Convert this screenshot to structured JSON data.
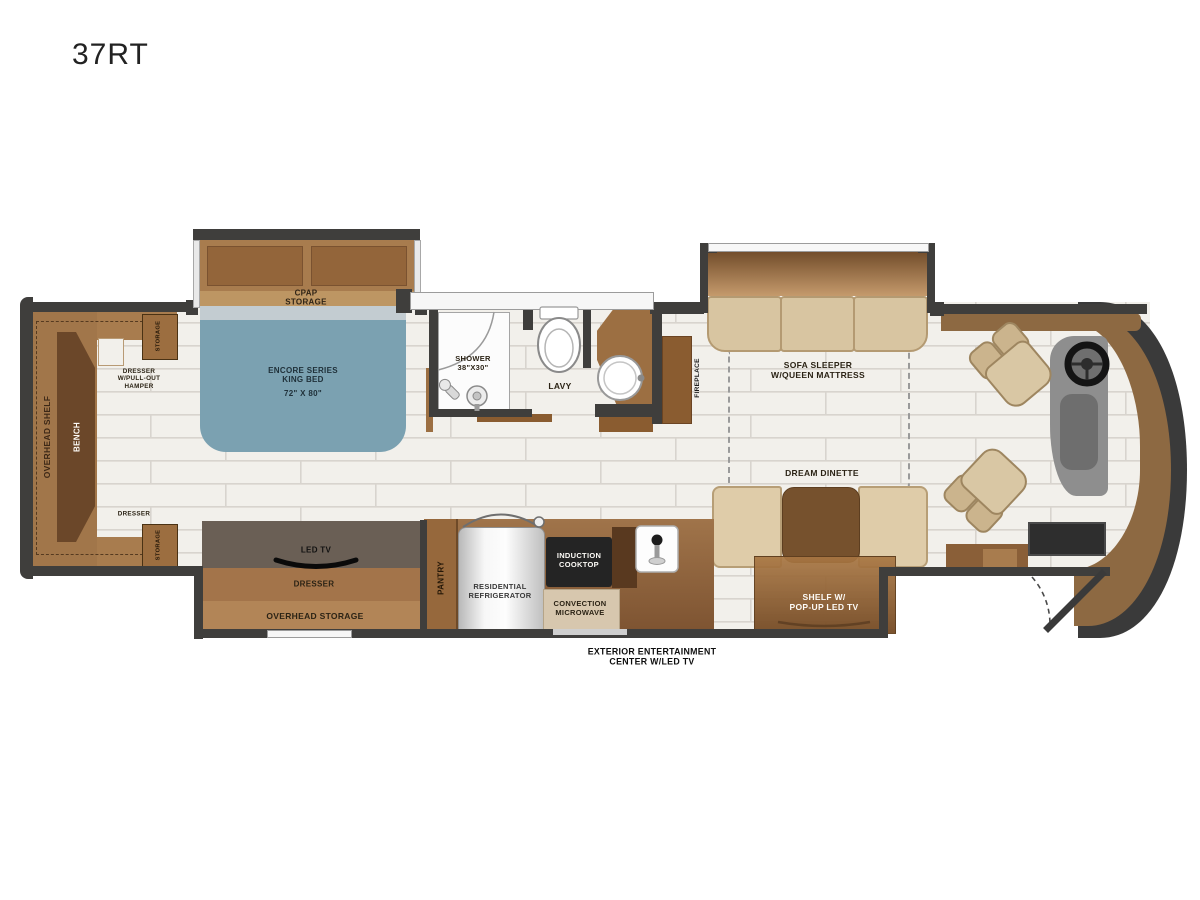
{
  "title": "37RT",
  "palette": {
    "wall": "#3f3e3c",
    "floor": "#f2f0eb",
    "cabinet_brown": "#9c6f42",
    "dark_brown": "#6d4a2b",
    "bed_blue": "#7ba1b1",
    "seat_tan": "#d9c7a4",
    "cooktop_black": "#222222",
    "fridge_silver": "#d9d9d9",
    "tv_taupe": "#6a5f55"
  },
  "bedroom": {
    "overhead_shelf": "OVERHEAD SHELF",
    "bench": "BENCH",
    "storage": "STORAGE",
    "hamper_l1": "DRESSER",
    "hamper_l2": "W/PULL-OUT",
    "hamper_l3": "HAMPER",
    "dresser": "DRESSER",
    "cpap_l1": "CPAP",
    "cpap_l2": "STORAGE",
    "bed_l1": "ENCORE SERIES",
    "bed_l2": "KING BED",
    "bed_l3": "72\" X 80\""
  },
  "bath": {
    "shower_l1": "SHOWER",
    "shower_l2": "38\"X30\"",
    "lavy": "LAVY"
  },
  "living": {
    "fireplace": "FIREPLACE",
    "sofa_l1": "SOFA SLEEPER",
    "sofa_l2": "W/QUEEN MATTRESS",
    "dinette": "DREAM DINETTE",
    "shelf_l1": "SHELF W/",
    "shelf_l2": "POP-UP LED TV"
  },
  "galley": {
    "pantry": "PANTRY",
    "fridge_l1": "RESIDENTIAL",
    "fridge_l2": "REFRIGERATOR",
    "cooktop_l1": "INDUCTION",
    "cooktop_l2": "COOKTOP",
    "micro_l1": "CONVECTION",
    "micro_l2": "MICROWAVE"
  },
  "media": {
    "led_tv": "LED TV",
    "dresser": "DRESSER",
    "overhead_storage": "OVERHEAD STORAGE"
  },
  "exterior": {
    "l1": "EXTERIOR ENTERTAINMENT",
    "l2": "CENTER W/LED TV"
  }
}
